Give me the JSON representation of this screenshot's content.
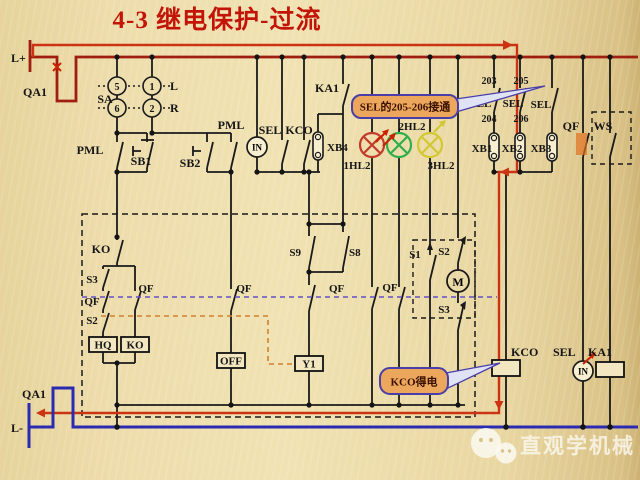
{
  "page": {
    "title": "4-3  继电保护-过流"
  },
  "power": {
    "positive": "L+",
    "negative": "L-",
    "breaker_top": "QA1",
    "breaker_bottom": "QA1"
  },
  "sa": {
    "label": "SA",
    "p5": "5",
    "p1": "1",
    "p6": "6",
    "p2": "2",
    "left": "L",
    "right": "R"
  },
  "ctrl": {
    "pml_a": "PML",
    "sb1": "SB1",
    "sb2": "SB2",
    "pml_b": "PML",
    "sel": "SEL",
    "kco": "KCO",
    "in": "IN",
    "ka1": "KA1",
    "xb4": "XB4"
  },
  "lamps": {
    "l1": "1HL2",
    "l2": "2HL2",
    "l3": "3HL2"
  },
  "prot": {
    "n203": "203",
    "n205": "205",
    "sel1": "SEL",
    "sel2": "SEL",
    "sel3": "SEL",
    "n204": "204",
    "n206": "206",
    "xb1": "XB1",
    "xb2": "XB2",
    "xb3": "XB3",
    "qf": "QF",
    "ws": "WS"
  },
  "box": {
    "ko": "KO",
    "s3": "S3",
    "qf_hq": "QF",
    "s2": "S2",
    "qf_ko": "QF",
    "hq": "HQ",
    "ko_coil": "KO",
    "qf_off": "QF",
    "off": "OFF",
    "s9": "S9",
    "s8": "S8",
    "qf_y1": "QF",
    "y1": "Y1",
    "qf_lamp": "QF",
    "s1": "S1",
    "s2m": "S2",
    "m": "M",
    "s3m": "S3"
  },
  "coils": {
    "kco": "KCO",
    "sel": "SEL",
    "in": "IN",
    "ka1": "KA1"
  },
  "callout_sel": {
    "text": "SEL的205-206接通"
  },
  "callout_kco": {
    "text": "KCO得电"
  },
  "watermark": {
    "text": "直观学机械"
  },
  "colors": {
    "bus_positive": "#9e1f10",
    "flow_path": "#cc3312",
    "bus_negative": "#2a2bb0",
    "qf_link_dashed": "#6050c8",
    "mech_link_dashed": "#d08030",
    "lamp_red": "#c23b2a",
    "lamp_green": "#2fae4c",
    "lamp_yellow": "#d2c832",
    "callout_fill": "#eda75c",
    "callout_border": "#4a3fa8",
    "title": "#c21507"
  }
}
